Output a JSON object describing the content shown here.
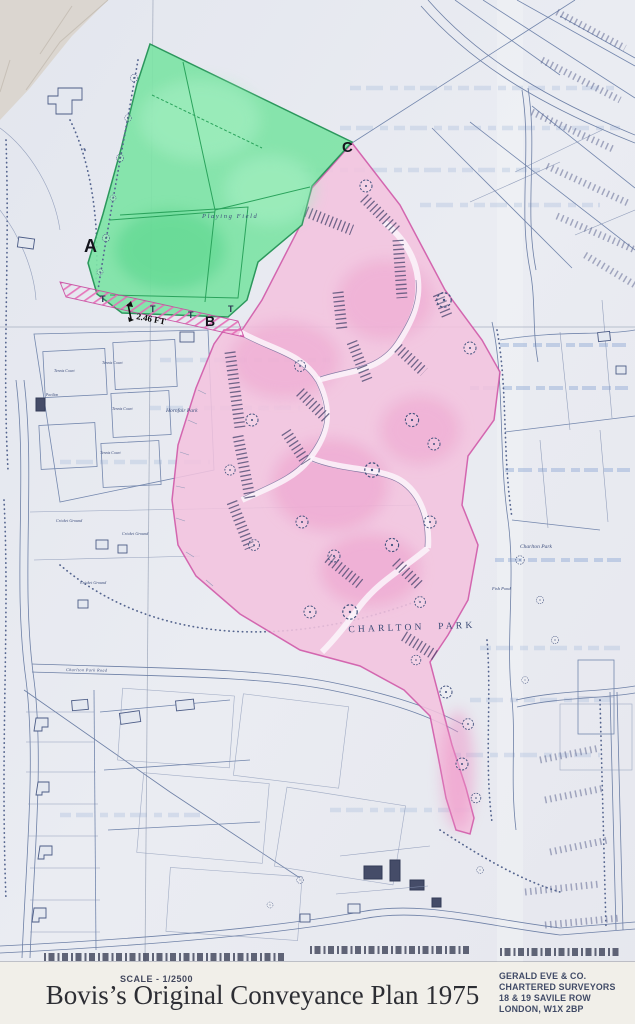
{
  "map": {
    "region_labels": {
      "point_a": "A",
      "point_b": "B",
      "point_c": "C",
      "boundary_mark": "T",
      "playing_field": "Playing Field",
      "strip_width": "2.46 FT",
      "estate_name": "CHARLTON PARK"
    },
    "place_labels": {
      "hornfair_park": "Hornfair Park",
      "tennis_court": "Tennis Court",
      "pavilion": "Pavilion",
      "cricket_ground": "Cricket Ground",
      "charlton_house": "Charlton Park",
      "fish_pond": "Fish Pond",
      "road_name": "Charlton Park Road"
    },
    "highlight_colors": {
      "conveyed_land_pink": "#f3c3de",
      "playing_field_green": "#7ee3a6",
      "outline_magenta": "#d054a6"
    }
  },
  "footer": {
    "scale_label": "SCALE - 1/2500",
    "caption": "Bovis’s Original Conveyance Plan 1975",
    "surveyor_lines": [
      "GERALD EVE & CO.",
      "CHARTERED SURVEYORS",
      "18 & 19 SAVILE ROW",
      "LONDON, W1X 2BP"
    ]
  }
}
